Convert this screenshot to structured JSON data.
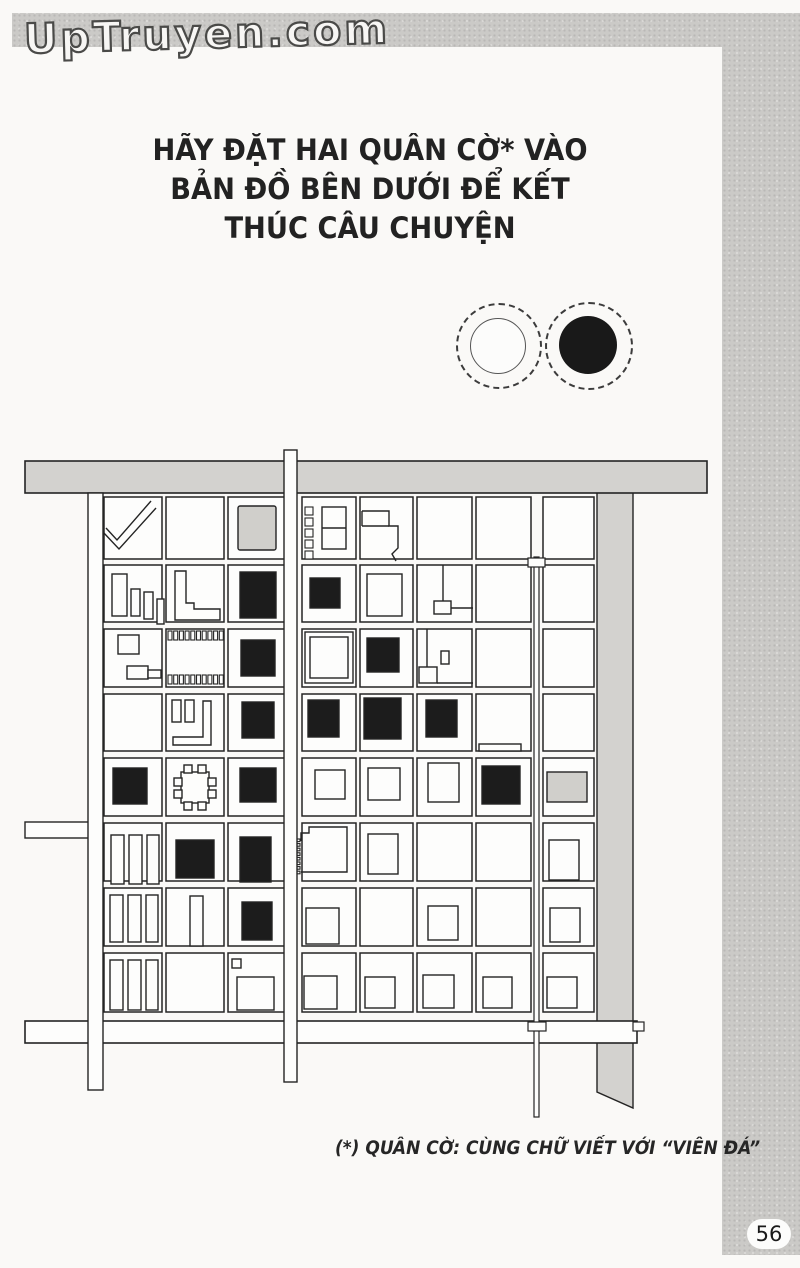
{
  "site": {
    "logo": "UpTruyen.com"
  },
  "page": {
    "number": "56"
  },
  "title": {
    "lines": [
      "HÃY ĐẶT HAI QUÂN CỜ* VÀO",
      "BẢN ĐỒ BÊN DƯỚI ĐỂ KẾT",
      "THÚC CÂU CHUYỆN"
    ]
  },
  "footnote": {
    "text": "(*) QUÂN CỜ: CÙNG CHỮ VIẾT VỚI “VIÊN ĐÁ”"
  },
  "stones": {
    "white": {
      "id": "white-stone",
      "fill": "#fcfcfb"
    },
    "black": {
      "id": "black-stone",
      "fill": "#191919"
    }
  },
  "colors": {
    "ink": "#242424",
    "road_gray": "#d3d2cf",
    "building_black": "#1c1c1c",
    "building_gray": "#d0cfcb",
    "block_fill": "#fdfdfc"
  },
  "map": {
    "ink": "#242424",
    "grid": {
      "cols": [
        [
          104,
          58
        ],
        [
          166,
          58
        ],
        [
          228,
          57
        ],
        [
          302,
          54
        ],
        [
          360,
          53
        ],
        [
          417,
          55
        ],
        [
          476,
          55
        ],
        [
          543,
          51
        ]
      ],
      "rows": [
        [
          497,
          62
        ],
        [
          565,
          57
        ],
        [
          629,
          58
        ],
        [
          694,
          57
        ],
        [
          758,
          58
        ],
        [
          823,
          58
        ],
        [
          888,
          58
        ],
        [
          953,
          59
        ]
      ]
    },
    "underlays": [
      {
        "name": "east-gray-road",
        "k": "path",
        "d": "M597,470 H633 V1108 L597,1092 Z",
        "f": "#d3d2cf"
      }
    ],
    "buildings": [
      {
        "cell": "r1c1",
        "k": "poly",
        "pts": "151,501 117,540 106,528"
      },
      {
        "cell": "r1c1",
        "k": "poly",
        "pts": "156,508 119,549 103,532"
      },
      {
        "cell": "r1c3",
        "k": "rect",
        "x": 238,
        "y": 506,
        "w": 38,
        "h": 44,
        "f": "#d0cfcb",
        "rx": 2
      },
      {
        "cell": "r1c4",
        "k": "comb",
        "x": 305,
        "y": 507,
        "n": 5,
        "dy": 11,
        "w": 8,
        "h": 8
      },
      {
        "cell": "r1c4",
        "k": "rect",
        "x": 322,
        "y": 507,
        "w": 24,
        "h": 42
      },
      {
        "cell": "r1c4",
        "k": "line",
        "x1": 322,
        "y1": 528,
        "x2": 346,
        "y2": 528
      },
      {
        "cell": "r1c5",
        "k": "poly",
        "pts": "362,511 389,511 389,526 398,526 398,548 392,554 396,561"
      },
      {
        "cell": "r1c5",
        "k": "line",
        "x1": 362,
        "y1": 511,
        "x2": 362,
        "y2": 526
      },
      {
        "cell": "r1c5",
        "k": "line",
        "x1": 362,
        "y1": 526,
        "x2": 389,
        "y2": 526
      },
      {
        "cell": "r2c1",
        "k": "rect",
        "x": 112,
        "y": 574,
        "w": 15,
        "h": 42
      },
      {
        "cell": "r2c1",
        "k": "rect",
        "x": 131,
        "y": 589,
        "w": 9,
        "h": 27
      },
      {
        "cell": "r2c1",
        "k": "rect",
        "x": 144,
        "y": 592,
        "w": 9,
        "h": 27
      },
      {
        "cell": "r2c1",
        "k": "rect",
        "x": 157,
        "y": 599,
        "w": 7,
        "h": 25
      },
      {
        "cell": "r2c2",
        "k": "poly",
        "closed": true,
        "pts": "175,571 186,571 186,603 194,603 194,609 220,609 220,620 175,620",
        "f": "#fdfdfc"
      },
      {
        "cell": "r2c3",
        "k": "rect",
        "x": 240,
        "y": 572,
        "w": 36,
        "h": 46,
        "f": "#1c1c1c"
      },
      {
        "cell": "r2c4",
        "k": "rect",
        "x": 310,
        "y": 578,
        "w": 30,
        "h": 30,
        "f": "#1c1c1c"
      },
      {
        "cell": "r2c5",
        "k": "rect",
        "x": 367,
        "y": 574,
        "w": 35,
        "h": 42
      },
      {
        "cell": "r2c6",
        "k": "line",
        "x1": 443,
        "y1": 565,
        "x2": 443,
        "y2": 601
      },
      {
        "cell": "r2c6",
        "k": "rect",
        "x": 434,
        "y": 601,
        "w": 17,
        "h": 13
      },
      {
        "cell": "r2c6",
        "k": "line",
        "x1": 451,
        "y1": 608,
        "x2": 473,
        "y2": 608
      },
      {
        "cell": "r3c1",
        "k": "rect",
        "x": 118,
        "y": 635,
        "w": 21,
        "h": 19
      },
      {
        "cell": "r3c1",
        "k": "rect",
        "x": 127,
        "y": 666,
        "w": 21,
        "h": 13
      },
      {
        "cell": "r3c1",
        "k": "rect",
        "x": 148,
        "y": 670,
        "w": 13,
        "h": 8
      },
      {
        "cell": "r3c2",
        "k": "comb",
        "x": 168,
        "y": 631,
        "n": 10,
        "dx": 5.7,
        "w": 4,
        "h": 9
      },
      {
        "cell": "r3c2",
        "k": "comb",
        "x": 168,
        "y": 675,
        "n": 10,
        "dx": 5.7,
        "w": 4,
        "h": 9
      },
      {
        "cell": "r3c3",
        "k": "rect",
        "x": 241,
        "y": 640,
        "w": 34,
        "h": 36,
        "f": "#1c1c1c"
      },
      {
        "cell": "r3c4",
        "k": "rect",
        "x": 305,
        "y": 632,
        "w": 48,
        "h": 51
      },
      {
        "cell": "r3c4",
        "k": "rect",
        "x": 310,
        "y": 637,
        "w": 38,
        "h": 41
      },
      {
        "cell": "r3c5",
        "k": "rect",
        "x": 367,
        "y": 638,
        "w": 32,
        "h": 34,
        "f": "#1c1c1c"
      },
      {
        "cell": "r3c6",
        "k": "line",
        "x1": 427,
        "y1": 629,
        "x2": 427,
        "y2": 667
      },
      {
        "cell": "r3c6",
        "k": "rect",
        "x": 441,
        "y": 651,
        "w": 8,
        "h": 13
      },
      {
        "cell": "r3c6",
        "k": "rect",
        "x": 419,
        "y": 667,
        "w": 18,
        "h": 16
      },
      {
        "cell": "r3c6",
        "k": "line",
        "x1": 437,
        "y1": 683,
        "x2": 473,
        "y2": 683
      },
      {
        "cell": "r4c2",
        "k": "rect",
        "x": 172,
        "y": 700,
        "w": 9,
        "h": 22
      },
      {
        "cell": "r4c2",
        "k": "rect",
        "x": 185,
        "y": 700,
        "w": 9,
        "h": 22
      },
      {
        "cell": "r4c2",
        "k": "poly",
        "closed": true,
        "pts": "203,701 211,701 211,745 173,745 173,737 203,737",
        "f": "#fdfdfc"
      },
      {
        "cell": "r4c3",
        "k": "rect",
        "x": 242,
        "y": 702,
        "w": 32,
        "h": 36,
        "f": "#1c1c1c"
      },
      {
        "cell": "r4c4",
        "k": "rect",
        "x": 308,
        "y": 700,
        "w": 31,
        "h": 37,
        "f": "#1c1c1c"
      },
      {
        "cell": "r4c5",
        "k": "rect",
        "x": 364,
        "y": 698,
        "w": 37,
        "h": 41,
        "f": "#1c1c1c"
      },
      {
        "cell": "r4c6",
        "k": "rect",
        "x": 426,
        "y": 700,
        "w": 31,
        "h": 37,
        "f": "#1c1c1c"
      },
      {
        "cell": "r4c7",
        "k": "rect",
        "x": 479,
        "y": 744,
        "w": 42,
        "h": 7
      },
      {
        "cell": "r5c1",
        "k": "rect",
        "x": 113,
        "y": 768,
        "w": 34,
        "h": 36,
        "f": "#1c1c1c"
      },
      {
        "cell": "r5c2",
        "k": "rect",
        "x": 181,
        "y": 772,
        "w": 28,
        "h": 31
      },
      {
        "cell": "r5c2",
        "k": "rect",
        "x": 184,
        "y": 765,
        "w": 8,
        "h": 8
      },
      {
        "cell": "r5c2",
        "k": "rect",
        "x": 198,
        "y": 765,
        "w": 8,
        "h": 8
      },
      {
        "cell": "r5c2",
        "k": "rect",
        "x": 184,
        "y": 802,
        "w": 8,
        "h": 8
      },
      {
        "cell": "r5c2",
        "k": "rect",
        "x": 198,
        "y": 802,
        "w": 8,
        "h": 8
      },
      {
        "cell": "r5c2",
        "k": "rect",
        "x": 174,
        "y": 778,
        "w": 8,
        "h": 8
      },
      {
        "cell": "r5c2",
        "k": "rect",
        "x": 174,
        "y": 790,
        "w": 8,
        "h": 8
      },
      {
        "cell": "r5c2",
        "k": "rect",
        "x": 208,
        "y": 778,
        "w": 8,
        "h": 8
      },
      {
        "cell": "r5c2",
        "k": "rect",
        "x": 208,
        "y": 790,
        "w": 8,
        "h": 8
      },
      {
        "cell": "r5c3",
        "k": "rect",
        "x": 240,
        "y": 768,
        "w": 36,
        "h": 34,
        "f": "#1c1c1c"
      },
      {
        "cell": "r5c4",
        "k": "rect",
        "x": 315,
        "y": 770,
        "w": 30,
        "h": 29
      },
      {
        "cell": "r5c5",
        "k": "rect",
        "x": 368,
        "y": 768,
        "w": 32,
        "h": 32
      },
      {
        "cell": "r5c6",
        "k": "rect",
        "x": 428,
        "y": 763,
        "w": 31,
        "h": 39
      },
      {
        "cell": "r5c7",
        "k": "rect",
        "x": 482,
        "y": 766,
        "w": 38,
        "h": 38,
        "f": "#1c1c1c"
      },
      {
        "cell": "r5c8",
        "k": "rect",
        "x": 547,
        "y": 772,
        "w": 40,
        "h": 30,
        "f": "#d0cfcb"
      },
      {
        "cell": "r6c1",
        "k": "rect",
        "x": 111,
        "y": 835,
        "w": 13,
        "h": 49
      },
      {
        "cell": "r6c1",
        "k": "rect",
        "x": 129,
        "y": 835,
        "w": 13,
        "h": 49
      },
      {
        "cell": "r6c1",
        "k": "rect",
        "x": 147,
        "y": 835,
        "w": 12,
        "h": 49
      },
      {
        "cell": "r6c2",
        "k": "rect",
        "x": 176,
        "y": 840,
        "w": 38,
        "h": 38,
        "f": "#1c1c1c"
      },
      {
        "cell": "r6c3",
        "k": "rect",
        "x": 240,
        "y": 837,
        "w": 31,
        "h": 45,
        "f": "#1c1c1c"
      },
      {
        "cell": "r6c4",
        "k": "comb",
        "x": 293,
        "y": 839,
        "n": 8,
        "dy": 4.6,
        "w": 7,
        "h": 2.6
      },
      {
        "cell": "r6c4",
        "k": "poly",
        "pts": "301,841 301,833 309,833 309,827 347,827 347,872 301,872"
      },
      {
        "cell": "r6c5",
        "k": "rect",
        "x": 368,
        "y": 834,
        "w": 30,
        "h": 40
      },
      {
        "cell": "r6c8",
        "k": "rect",
        "x": 549,
        "y": 840,
        "w": 30,
        "h": 40
      },
      {
        "cell": "r7c1",
        "k": "rect",
        "x": 110,
        "y": 895,
        "w": 13,
        "h": 47
      },
      {
        "cell": "r7c1",
        "k": "rect",
        "x": 128,
        "y": 895,
        "w": 13,
        "h": 47
      },
      {
        "cell": "r7c1",
        "k": "rect",
        "x": 146,
        "y": 895,
        "w": 12,
        "h": 47
      },
      {
        "cell": "r7c2",
        "k": "rect",
        "x": 190,
        "y": 896,
        "w": 13,
        "h": 50
      },
      {
        "cell": "r7c3",
        "k": "rect",
        "x": 242,
        "y": 902,
        "w": 30,
        "h": 38,
        "f": "#1c1c1c"
      },
      {
        "cell": "r7c4",
        "k": "rect",
        "x": 306,
        "y": 908,
        "w": 33,
        "h": 36
      },
      {
        "cell": "r7c6",
        "k": "rect",
        "x": 428,
        "y": 906,
        "w": 30,
        "h": 34
      },
      {
        "cell": "r7c8",
        "k": "rect",
        "x": 550,
        "y": 908,
        "w": 30,
        "h": 34
      },
      {
        "cell": "r8c1",
        "k": "rect",
        "x": 110,
        "y": 960,
        "w": 13,
        "h": 50
      },
      {
        "cell": "r8c1",
        "k": "rect",
        "x": 128,
        "y": 960,
        "w": 13,
        "h": 50
      },
      {
        "cell": "r8c1",
        "k": "rect",
        "x": 146,
        "y": 960,
        "w": 12,
        "h": 50
      },
      {
        "cell": "r8c3",
        "k": "rect",
        "x": 232,
        "y": 959,
        "w": 9,
        "h": 9
      },
      {
        "cell": "r8c3",
        "k": "rect",
        "x": 237,
        "y": 977,
        "w": 37,
        "h": 33
      },
      {
        "cell": "r8c4",
        "k": "rect",
        "x": 304,
        "y": 976,
        "w": 33,
        "h": 33
      },
      {
        "cell": "r8c5",
        "k": "rect",
        "x": 365,
        "y": 977,
        "w": 30,
        "h": 31
      },
      {
        "cell": "r8c6",
        "k": "rect",
        "x": 423,
        "y": 975,
        "w": 31,
        "h": 33
      },
      {
        "cell": "r8c7",
        "k": "rect",
        "x": 483,
        "y": 977,
        "w": 29,
        "h": 31
      },
      {
        "cell": "r8c8",
        "k": "rect",
        "x": 547,
        "y": 977,
        "w": 30,
        "h": 31
      }
    ],
    "overlays": [
      {
        "name": "top-road",
        "k": "rect",
        "x": 25,
        "y": 461,
        "w": 682,
        "h": 32,
        "f": "#d3d2cf",
        "sw": 1.6
      },
      {
        "name": "bottom-road",
        "k": "rect",
        "x": 25,
        "y": 1021,
        "w": 612,
        "h": 22,
        "f": "#fdfdfc",
        "sw": 1.6
      },
      {
        "name": "bottom-road-stub",
        "k": "rect",
        "x": 633,
        "y": 1022,
        "w": 11,
        "h": 9,
        "f": "#fdfdfc",
        "sw": 1.2
      },
      {
        "name": "west-branch-road",
        "k": "rect",
        "x": 25,
        "y": 822,
        "w": 66,
        "h": 16,
        "f": "#fdfdfc",
        "sw": 1.4
      },
      {
        "name": "west-road",
        "k": "rect",
        "x": 88,
        "y": 493,
        "w": 15,
        "h": 597,
        "f": "#fdfdfc",
        "sw": 1.4
      },
      {
        "name": "main-vertical-road",
        "k": "rect",
        "x": 284,
        "y": 450,
        "w": 13,
        "h": 632,
        "f": "#fdfdfc",
        "sw": 1.4
      },
      {
        "name": "east-lane",
        "k": "rect",
        "x": 534,
        "y": 557,
        "w": 5,
        "h": 560,
        "f": "#fdfdfc",
        "sw": 1.2
      },
      {
        "name": "lane-node-top",
        "k": "rect",
        "x": 528,
        "y": 558,
        "w": 17,
        "h": 9,
        "f": "#fdfdfc",
        "sw": 1.2
      },
      {
        "name": "lane-node-bottom",
        "k": "rect",
        "x": 528,
        "y": 1022,
        "w": 18,
        "h": 9,
        "f": "#fdfdfc",
        "sw": 1.2
      }
    ]
  }
}
